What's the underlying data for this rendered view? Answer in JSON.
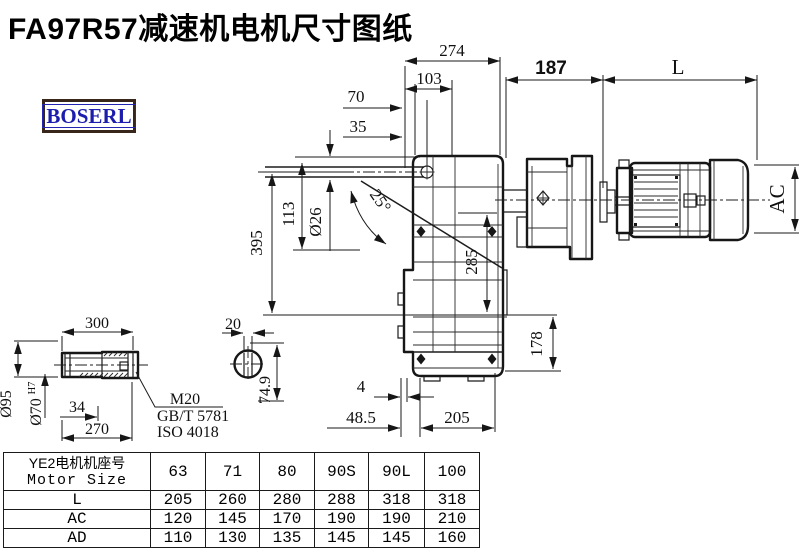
{
  "page": {
    "title": "FA97R57减速机电机尺寸图纸",
    "brand": "BOSERL"
  },
  "dims": {
    "w274": "274",
    "w103": "103",
    "w70": "70",
    "w35": "35",
    "w187": "187",
    "wL": "L",
    "h395": "395",
    "h113": "113",
    "hole_dia": "Ø26",
    "angle": "25°",
    "h285": "285",
    "h178": "178",
    "gap4": "4",
    "b48_5": "48.5",
    "b205": "205",
    "motor_ac": "AC"
  },
  "shaft": {
    "len300": "300",
    "key20": "20",
    "dia95": "Ø95",
    "dia70": "Ø70",
    "fit": "H7",
    "len34": "34",
    "len270": "270",
    "height74_9": "74.9",
    "thread": "M20",
    "std_gb": "GB/T 5781",
    "std_iso": "ISO 4018"
  },
  "table": {
    "header_cn": "YE2电机机座号",
    "header_en": "Motor Size",
    "columns": [
      "63",
      "71",
      "80",
      "90S",
      "90L",
      "100"
    ],
    "rows": [
      {
        "label": "L",
        "values": [
          "205",
          "260",
          "280",
          "288",
          "318",
          "318"
        ]
      },
      {
        "label": "AC",
        "values": [
          "120",
          "145",
          "170",
          "190",
          "190",
          "210"
        ]
      },
      {
        "label": "AD",
        "values": [
          "110",
          "130",
          "135",
          "145",
          "145",
          "160"
        ]
      }
    ]
  }
}
